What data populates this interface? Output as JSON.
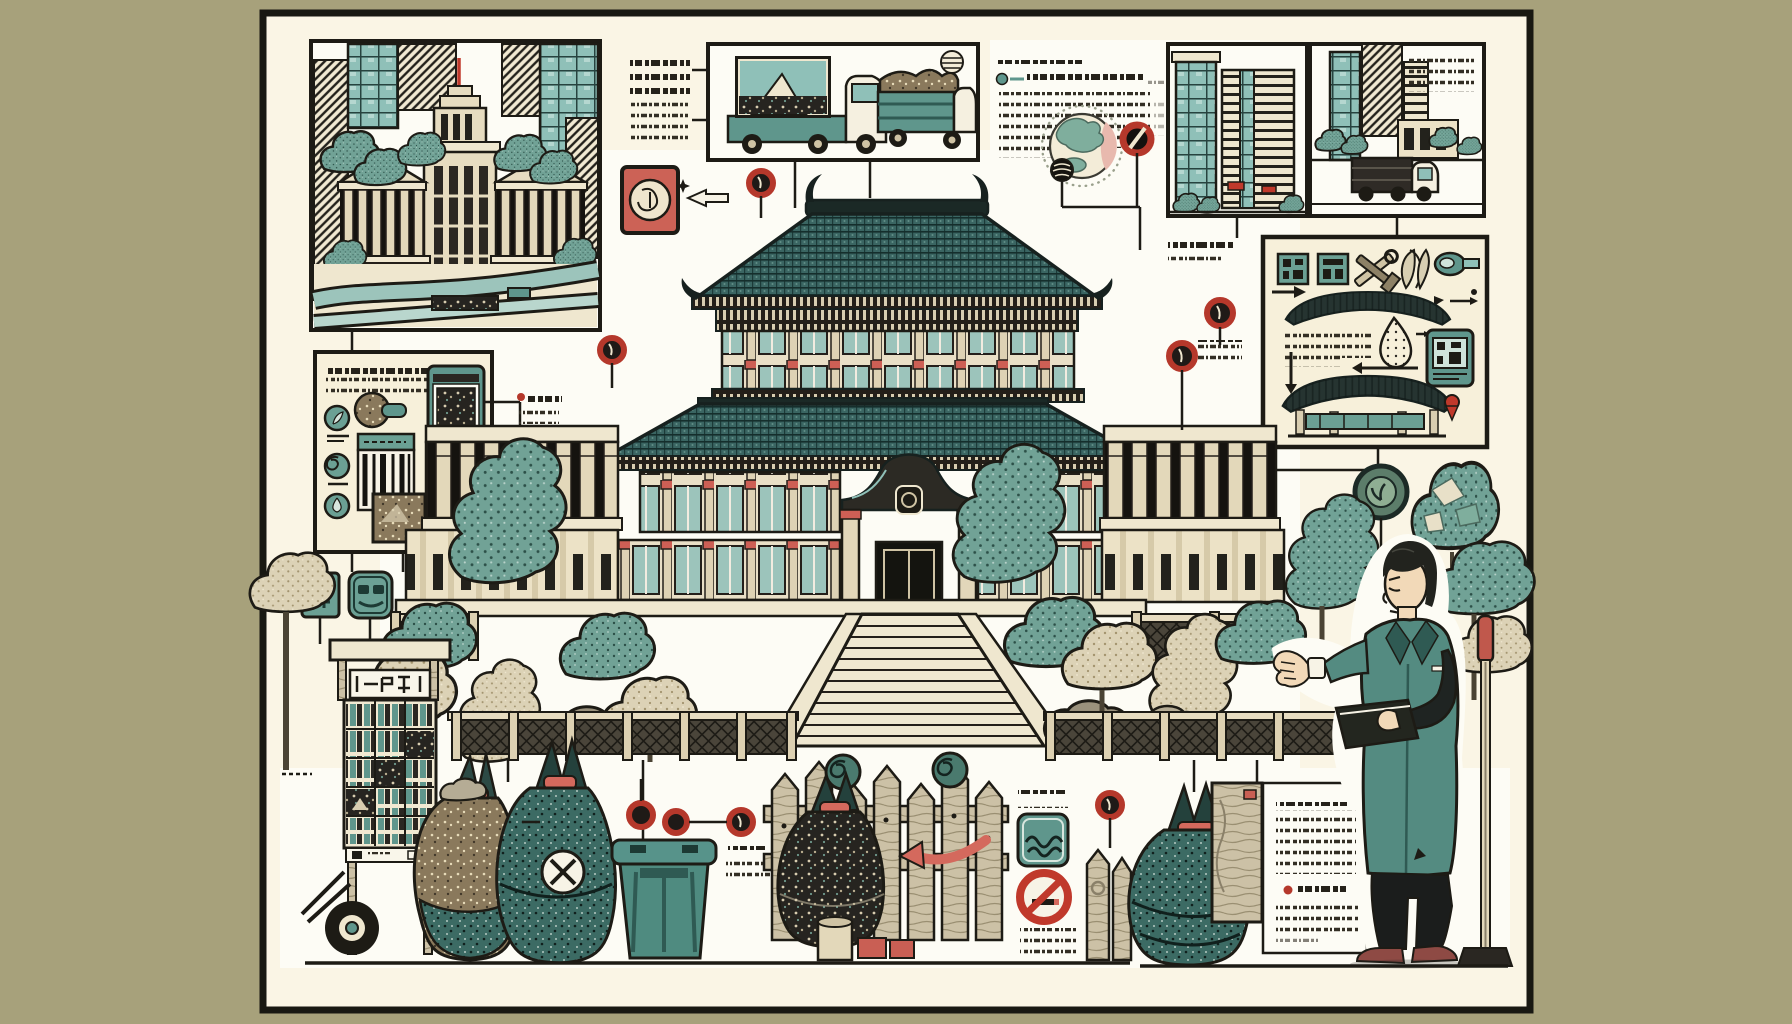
{
  "meta": {
    "title": "Illustrated infographic poster: East Asian government palace, waste collection rules and city scenes",
    "type": "hand-drawn infographic illustration",
    "note": "Every paragraph, label and sign in the artwork is illegible decorative pseudo-text (dash strokes and pseudo-kanji marks); no legible words are rendered anywhere in the image.",
    "canvas": {
      "width": 1792,
      "height": 1024
    }
  },
  "palette": {
    "outer_background": "#a7a17b",
    "poster_background": "#faf5e5",
    "panel_white": "#fdfcf5",
    "ink": "#1d1b15",
    "roof_teal": "#3a6562",
    "teal_mid": "#5f968c",
    "teal_light": "#8fc0b8",
    "tree_teal": "#71a296",
    "tree_beige": "#dcd2b6",
    "wood": "#ccc1a6",
    "stamp_red": "#cc6256",
    "marker_red": "#b5382b",
    "accent_red": "#d4695d",
    "skin": "#f2d9b8",
    "blazer_teal": "#548b81"
  },
  "poster": {
    "frame_color": "#181812",
    "frame_width_px": 7
  },
  "regions": [
    {
      "name": "city-government-panel",
      "description": "Framed drawing of a parliament-style tower with pediment wings, skyscrapers, trees and crossing roads",
      "pseudo_text_blocks": 0
    },
    {
      "name": "intro-text-column",
      "description": "Two clusters of dashed pseudo-text with connector lines into the truck panel",
      "pseudo_text_blocks": 2
    },
    {
      "name": "garbage-truck-panel",
      "description": "Framed drawing of a billboard truck showing a mountain picture and an open truck heaped with refuse; swirl sun in corner",
      "pseudo_text_blocks": 0
    },
    {
      "name": "lead-paragraph",
      "description": "Heading dashes, teal bullet line and fading paragraph of pseudo-text beside a globe",
      "pseudo_text_blocks": 3
    },
    {
      "name": "globe-figure",
      "description": "Globe with teal landmasses, pink crescent, dotted halo and a dark striped ball",
      "pseudo_text_blocks": 0
    },
    {
      "name": "office-buildings-panel",
      "description": "Framed drawing of two modern office towers with bushes and small red shop signs",
      "pseudo_text_blocks": 0
    },
    {
      "name": "street-truck-panel",
      "description": "Framed city street with a small flatbed truck and inset pseudo-text",
      "pseudo_text_blocks": 1
    },
    {
      "name": "process-panel",
      "description": "Framed instruction panel: teal stamp squares, crossed tools, leaves, tag, two dark tiled roof silhouettes, dotted droplet, QR device, arrows and a red map pin",
      "pseudo_text_blocks": 2
    },
    {
      "name": "app-panel",
      "description": "Framed panel with teal circular icons, a garbage ball, a smartphone photographing refuse, a barcode card and a refuse photo",
      "pseudo_text_blocks": 3
    },
    {
      "name": "palace-scene",
      "description": "Large two-tier palace with teal tiled hip-and-gable roofs, red-capped columns, curved entrance gable with crest, grand staircase, lattice balustrades, sculpted teal and beige trees and rocks",
      "pseudo_text_blocks": 0
    },
    {
      "name": "red-stamp-sign",
      "description": "Salmon-red square stamp with circular emblem, sparkle and white arrow pointing toward the palace",
      "pseudo_text_blocks": 0
    },
    {
      "name": "marker-callouts",
      "description": "Small dark-red ring markers with stems and short pseudo-text captions scattered around the palace and fences",
      "pseudo_text_blocks": 4
    },
    {
      "name": "newsstand-cart",
      "description": "Wheeled kiosk cart stacked with teal printed matter, pseudo-kanji signboard and a beige tree",
      "pseudo_text_blocks": 1
    },
    {
      "name": "garbage-bags-left",
      "description": "Two tied refuse sacks (brown-flecked and teal with a white X emblem) beside a teal wheelie bin",
      "pseudo_text_blocks": 0
    },
    {
      "name": "picket-fence-scene",
      "description": "Wood picket fence with two spiral finial balls, a dark tied sack, red curved arrow, stump and red blocks",
      "pseudo_text_blocks": 0
    },
    {
      "name": "prohibition-signs",
      "description": "Teal rounded wave sign and a red no-smoking circle between pseudo-text captions, with picket pair",
      "pseudo_text_blocks": 2
    },
    {
      "name": "plank-and-card",
      "description": "Wood plank with small red tag beside a white card of pseudo-text with a red bulleted item",
      "pseudo_text_blocks": 2
    },
    {
      "name": "spokesman-figure",
      "description": "Man in a teal blazer and dark tie with white outline halo, gesturing with open hand, holding a dark folder, beside a red-gripped stand",
      "pseudo_text_blocks": 0
    },
    {
      "name": "emblem-and-foliage",
      "description": "Dark teal circular emblem with sprout glyph and a mosaic foliage ball connected by elbow lines to the panels above",
      "pseudo_text_blocks": 0
    }
  ],
  "icons": [
    "red-stamp-emblem-icon",
    "sparkle-icon",
    "white-arrow-icon",
    "marker-ring-icon",
    "slash-circle-icon",
    "globe-icon",
    "striped-ball-icon",
    "swirl-sun-icon",
    "teal-stamp-icon",
    "crossed-tools-icon",
    "leaf-pair-icon",
    "tag-loupe-icon",
    "roof-silhouette-icon",
    "dotted-droplet-icon",
    "qr-device-icon",
    "map-pin-icon",
    "elbow-arrow-icon",
    "leaf-circle-icon",
    "garbage-ball-icon",
    "smartphone-icon",
    "barcode-card-icon",
    "kanji-sign-icon",
    "spiral-sign-icon",
    "wave-sign-icon",
    "no-smoking-icon",
    "spiral-finial-icon",
    "x-emblem-icon",
    "wheelie-bin-icon",
    "sprout-emblem-icon",
    "mosaic-foliage-icon",
    "mic-stand-icon"
  ]
}
